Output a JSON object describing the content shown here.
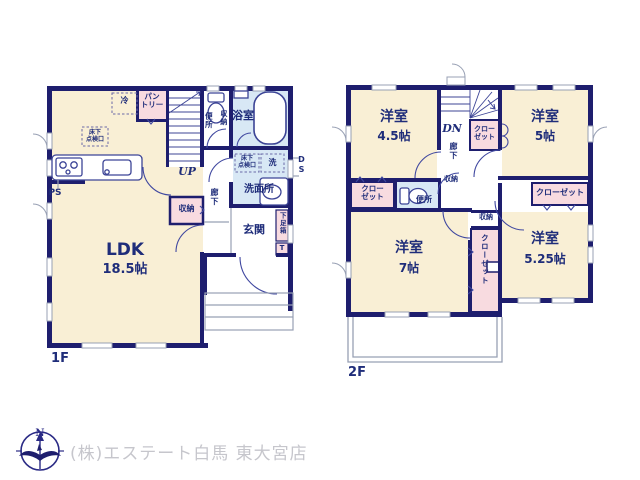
{
  "colors": {
    "wall_navy": "#1e1e6e",
    "room_cream": "#f9efd5",
    "closet_pink": "#f8dbe0",
    "wet_area_blue": "#d8e8f5",
    "line_gray": "#98a0b4",
    "text_navy": "#1f2d7a",
    "logo_gray": "#c6c6cc"
  },
  "f1": {
    "floor_label": "1F",
    "ldk_name": "LDK",
    "ldk_size": "18.5帖",
    "pantry_l1": "パン",
    "pantry_l2": "トリー",
    "fridge": "冷",
    "hatch_l1": "床下",
    "hatch_l2": "点検口",
    "up": "UP",
    "toilet": "便所",
    "toilet_storage": "収納",
    "bath": "浴室",
    "hatch2_l1": "床下",
    "hatch2_l2": "点検口",
    "wash_machine": "洗",
    "ds": "DS",
    "washroom": "洗面所",
    "hall": "廊下",
    "storage": "収納",
    "entrance": "玄関",
    "shoebox": "下足箱",
    "shoebox_t": "T",
    "ps": "PS"
  },
  "f2": {
    "floor_label": "2F",
    "room45_name": "洋室",
    "room45_size": "4.5帖",
    "room5_name": "洋室",
    "room5_size": "5帖",
    "room7_name": "洋室",
    "room7_size": "7帖",
    "room525_name": "洋室",
    "room525_size": "5.25帖",
    "dn": "DN",
    "closet_stairs_l1": "クロー",
    "closet_stairs_l2": "ゼット",
    "closet_left_l1": "クロー",
    "closet_left_l2": "ゼット",
    "closet_right": "クローゼット",
    "closet_mid_v": "クローゼット",
    "toilet": "便所",
    "hall": "廊下",
    "storage_label": "収納",
    "storage_box": "収納"
  },
  "footer": {
    "company": "(株)エステート白馬 東大宮店",
    "compass_n": "N"
  }
}
